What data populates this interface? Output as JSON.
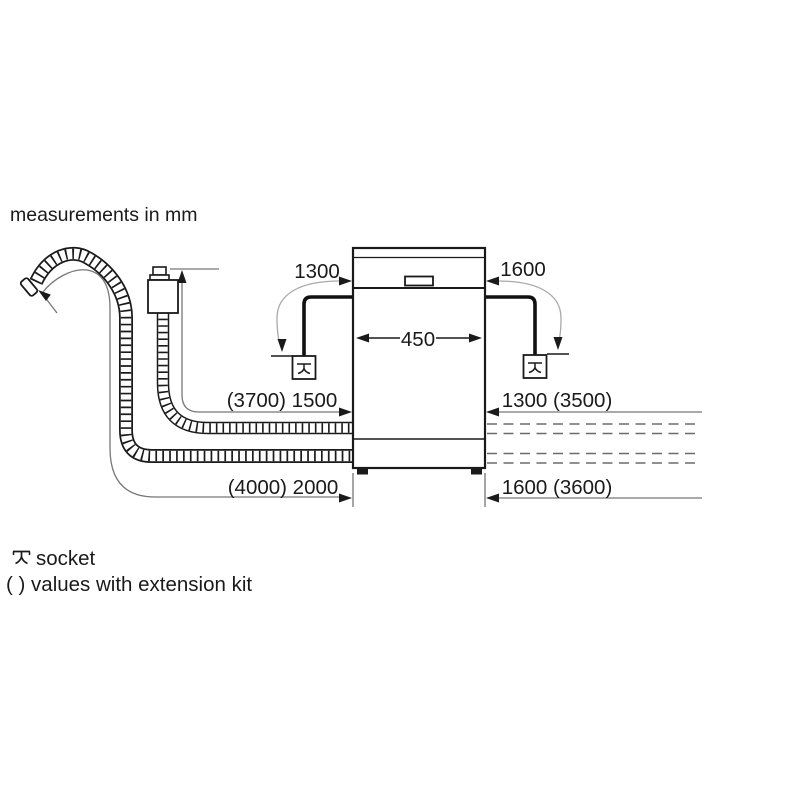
{
  "title": "measurements in mm",
  "dims": {
    "socket_distance_left": "1300",
    "socket_distance_right": "1600",
    "appliance_width": "450",
    "supply_hose_left": "(3700) 1500",
    "drain_hose_left": "(4000) 2000",
    "supply_hose_right": "1300 (3500)",
    "drain_hose_right": "1600 (3600)"
  },
  "legend": {
    "socket": "socket",
    "extension": "( ) values with extension kit"
  },
  "colors": {
    "line": "#1a1a1a",
    "dimension_line": "#777777",
    "arc_line": "#a9a9a9",
    "background": "#ffffff"
  }
}
